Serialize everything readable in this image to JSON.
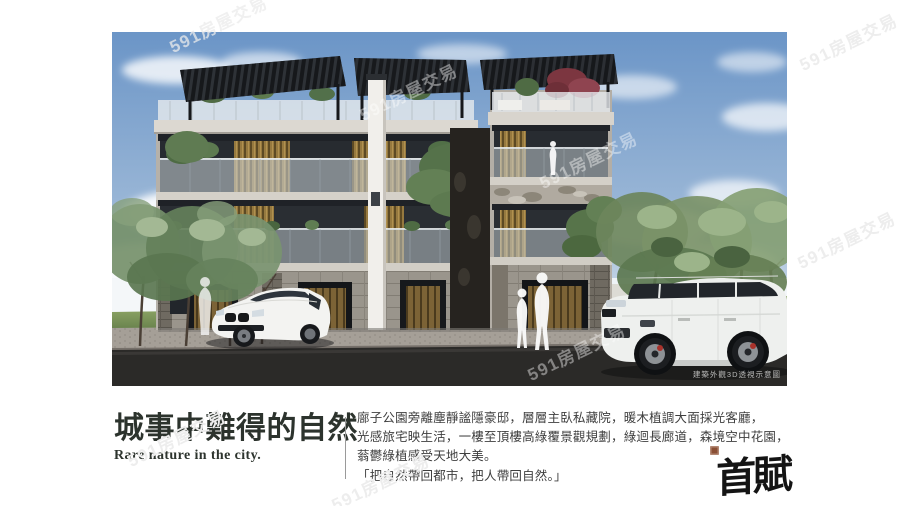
{
  "watermark": {
    "text": "591房屋交易"
  },
  "hero": {
    "caption": "建築外觀3D透視示意圖"
  },
  "content": {
    "title": "城事中難得的自然",
    "subtitle": "Rare nature in the city.",
    "paragraph_lines": [
      "廍子公園旁離塵靜謐隱豪邸，層層主臥私藏院，暖木植調大面採光客廳，",
      "光感旅宅映生活，一樓至頂樓高綠覆景觀規劃，綠迴長廊道，森境空中花園，",
      "蓊鬱綠植感受天地大美。",
      "「把自然帶回都市，把人帶回自然。」"
    ]
  },
  "logo": {
    "text": "首賦"
  },
  "colors": {
    "title_text": "#2c332d",
    "body_text": "#3e3e3e",
    "seal": "#8a4f35",
    "sky": "#6d96c6",
    "wood_accent": "#96793f",
    "asphalt": "#2b2a28"
  }
}
